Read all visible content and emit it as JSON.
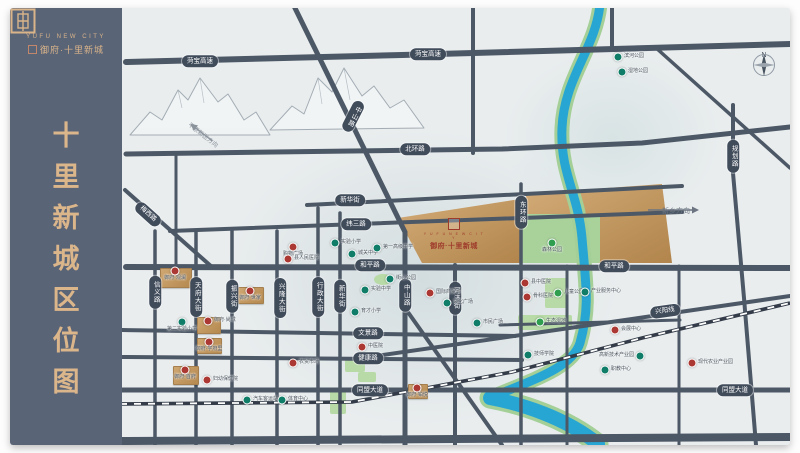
{
  "sidebar": {
    "logo_en": "YUFU NEW CITY",
    "logo_cn": "御府·十里新城",
    "title_chars": [
      "十",
      "里",
      "新",
      "城",
      "区",
      "位",
      "图"
    ]
  },
  "project": {
    "brand_en": "Y U F U N E W C I T Y",
    "name": "御府·十里新城"
  },
  "map": {
    "compass_n": "N",
    "arrows": {
      "new_district": "平原新区方向",
      "xinxiang": "新乡方向"
    },
    "colors": {
      "road": "#4d5866",
      "gold": "#c79e66",
      "river": "#27a6d4",
      "park": "#b7daa6",
      "poi_red": "#ab3832",
      "poi_teal": "#0f7d68",
      "sidebar": "#5a6477",
      "gold_text": "#d9b489"
    },
    "road_labels": [
      {
        "t": "菏宝高速",
        "x": 78,
        "y": 53
      },
      {
        "t": "菏宝高速",
        "x": 306,
        "y": 46
      },
      {
        "t": "北环路",
        "x": 293,
        "y": 141
      },
      {
        "t": "新华街",
        "x": 228,
        "y": 192
      },
      {
        "t": "纬三路",
        "x": 234,
        "y": 216
      },
      {
        "t": "和平路",
        "x": 248,
        "y": 257
      },
      {
        "t": "和平路",
        "x": 492,
        "y": 258
      },
      {
        "t": "文景路",
        "x": 246,
        "y": 325
      },
      {
        "t": "健康路",
        "x": 246,
        "y": 350
      },
      {
        "t": "同盟大道",
        "x": 248,
        "y": 382
      },
      {
        "t": "同盟大道",
        "x": 613,
        "y": 382
      },
      {
        "t": "兴阳线",
        "x": 543,
        "y": 303,
        "r": -8
      },
      {
        "t": "梅西路",
        "x": 26,
        "y": 206,
        "r": 42
      },
      {
        "t": "中山路",
        "x": 231,
        "y": 108,
        "v": true,
        "r": 27
      },
      {
        "t": "中山路",
        "x": 283,
        "y": 287,
        "v": true
      },
      {
        "t": "河济街",
        "x": 333,
        "y": 290,
        "v": true
      },
      {
        "t": "东环路",
        "x": 399,
        "y": 204,
        "v": true
      },
      {
        "t": "规划路",
        "x": 611,
        "y": 148,
        "v": true
      },
      {
        "t": "信义路",
        "x": 33,
        "y": 284,
        "v": true
      },
      {
        "t": "天府大街",
        "x": 74,
        "y": 289,
        "v": true
      },
      {
        "t": "振兴街",
        "x": 110,
        "y": 288,
        "v": true
      },
      {
        "t": "兴隆大街",
        "x": 158,
        "y": 290,
        "v": true
      },
      {
        "t": "行政大街",
        "x": 196,
        "y": 289,
        "v": true
      },
      {
        "t": "新华街",
        "x": 218,
        "y": 288,
        "v": true
      }
    ],
    "pois": [
      {
        "x": 171,
        "y": 239,
        "c": "red",
        "t": "购物广场",
        "p": "below"
      },
      {
        "x": 166,
        "y": 251,
        "c": "red",
        "t": "县人民医院",
        "p": "right"
      },
      {
        "x": 213,
        "y": 235,
        "c": "teal",
        "t": "实验小学",
        "p": "right"
      },
      {
        "x": 230,
        "y": 246,
        "c": "teal",
        "t": "城关中学",
        "p": "right"
      },
      {
        "x": 255,
        "y": 240,
        "c": "teal",
        "t": "第一高级中学",
        "p": "right"
      },
      {
        "x": 268,
        "y": 271,
        "c": "teal",
        "t": "街心公园",
        "p": "right"
      },
      {
        "x": 243,
        "y": 282,
        "c": "teal",
        "t": "实验中学",
        "p": "right"
      },
      {
        "x": 53,
        "y": 263,
        "c": "red",
        "t": "御府·观澜",
        "p": "below"
      },
      {
        "x": 128,
        "y": 283,
        "c": "red",
        "t": "御府·世家",
        "p": "below"
      },
      {
        "x": 60,
        "y": 314,
        "c": "teal",
        "t": "第二实验小学",
        "p": "below"
      },
      {
        "x": 86,
        "y": 313,
        "c": "red",
        "t": "御府·尚城",
        "p": "right"
      },
      {
        "x": 87,
        "y": 334,
        "c": "red",
        "t": "御府·学府里",
        "p": "below"
      },
      {
        "x": 63,
        "y": 362,
        "c": "red",
        "t": "御府·首府",
        "p": "below"
      },
      {
        "x": 85,
        "y": 372,
        "c": "red",
        "t": "妇幼保健院",
        "p": "right"
      },
      {
        "x": 125,
        "y": 392,
        "c": "teal",
        "t": "汽车客运站",
        "p": "right"
      },
      {
        "x": 160,
        "y": 392,
        "c": "teal",
        "t": "体育中心",
        "p": "right"
      },
      {
        "x": 171,
        "y": 355,
        "c": "red",
        "t": "农贸市场",
        "p": "right"
      },
      {
        "x": 240,
        "y": 339,
        "c": "red",
        "t": "中医院",
        "p": "right"
      },
      {
        "x": 233,
        "y": 304,
        "c": "teal",
        "t": "育才小学",
        "p": "right"
      },
      {
        "x": 295,
        "y": 380,
        "c": "red",
        "t": "御府·铂悦",
        "p": "below"
      },
      {
        "x": 308,
        "y": 285,
        "c": "red",
        "t": "国际商贸城",
        "p": "right"
      },
      {
        "x": 325,
        "y": 295,
        "c": "teal",
        "t": "文化广场",
        "p": "right"
      },
      {
        "x": 355,
        "y": 315,
        "c": "teal",
        "t": "市民广场",
        "p": "right"
      },
      {
        "x": 403,
        "y": 275,
        "c": "red",
        "t": "县中医院",
        "p": "right"
      },
      {
        "x": 405,
        "y": 289,
        "c": "red",
        "t": "骨科医院",
        "p": "right"
      },
      {
        "x": 430,
        "y": 235,
        "c": "green",
        "t": "森林公园",
        "p": "below"
      },
      {
        "x": 436,
        "y": 285,
        "c": "green",
        "t": "儿童公园",
        "p": "right"
      },
      {
        "x": 418,
        "y": 314,
        "c": "green",
        "t": "生态湿地",
        "p": "right"
      },
      {
        "x": 463,
        "y": 284,
        "c": "teal",
        "t": "产业服务中心",
        "p": "right"
      },
      {
        "x": 493,
        "y": 322,
        "c": "red",
        "t": "会展中心",
        "p": "right"
      },
      {
        "x": 483,
        "y": 362,
        "c": "teal",
        "t": "职教中心",
        "p": "right"
      },
      {
        "x": 406,
        "y": 347,
        "c": "teal",
        "t": "技师学院",
        "p": "right"
      },
      {
        "x": 570,
        "y": 355,
        "c": "red",
        "t": "现代农业产业园",
        "p": "right"
      },
      {
        "x": 518,
        "y": 348,
        "c": "teal",
        "t": "高新技术产业园",
        "p": "left"
      },
      {
        "x": 496,
        "y": 49,
        "c": "teal",
        "t": "滨河公园",
        "p": "right"
      },
      {
        "x": 500,
        "y": 64,
        "c": "teal",
        "t": "湿地公园",
        "p": "right"
      }
    ],
    "gold_blocks": [
      {
        "x": 38,
        "y": 260,
        "w": 30,
        "h": 18
      },
      {
        "x": 116,
        "y": 279,
        "w": 24,
        "h": 15
      },
      {
        "x": 75,
        "y": 309,
        "w": 22,
        "h": 15
      },
      {
        "x": 75,
        "y": 330,
        "w": 23,
        "h": 14
      },
      {
        "x": 51,
        "y": 358,
        "w": 24,
        "h": 17
      },
      {
        "x": 286,
        "y": 376,
        "w": 18,
        "h": 13
      }
    ],
    "parks": [
      {
        "x": 398,
        "y": 206,
        "w": 80,
        "h": 49,
        "big": true
      },
      {
        "x": 423,
        "y": 270,
        "w": 23,
        "h": 30
      },
      {
        "x": 396,
        "y": 307,
        "w": 54,
        "h": 15
      },
      {
        "x": 252,
        "y": 266,
        "w": 18,
        "h": 11,
        "ell": true
      },
      {
        "x": 223,
        "y": 352,
        "w": 20,
        "h": 12
      },
      {
        "x": 236,
        "y": 364,
        "w": 18,
        "h": 10
      },
      {
        "x": 208,
        "y": 382,
        "w": 16,
        "h": 24
      }
    ]
  }
}
